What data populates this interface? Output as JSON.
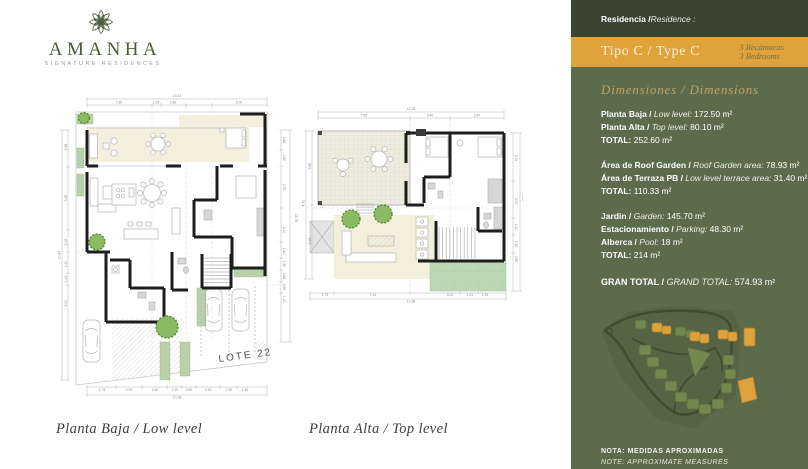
{
  "brand": {
    "name": "AMANHA",
    "tagline": "SIGNATURE RESIDENCES",
    "rosette_icon": "mandala-rosette"
  },
  "captions": {
    "planta_baja": "Planta Baja / Low level",
    "planta_alta": "Planta Alta / Top level"
  },
  "lot_label": "LOTE 22",
  "sidebar": {
    "residence_label_es": "Residencia / ",
    "residence_label_en": "Residence :",
    "type": {
      "title": "Tipo C / Type C",
      "bedrooms_es": "3 Recámaras",
      "bedrooms_en": "3 Bedrooms"
    },
    "dimensions_heading": "Dimensiones / Dimensions",
    "groups": [
      {
        "rows": [
          {
            "es": "Planta Baja / ",
            "en": "Low level:",
            "value": "172.50 m²"
          },
          {
            "es": "Planta Alta / ",
            "en": "Top level:",
            "value": "80.10 m²"
          }
        ],
        "total_label": "TOTAL:",
        "total_value": "252.60 m²"
      },
      {
        "rows": [
          {
            "es": "Área de Roof Garden / ",
            "en": "Roof Garden area:",
            "value": "78.93 m²"
          },
          {
            "es": "Área de Terraza PB / ",
            "en": "Low level terrace area:",
            "value": "31.40 m²"
          }
        ],
        "total_label": "TOTAL:",
        "total_value": "110.33 m²"
      },
      {
        "rows": [
          {
            "es": "Jardin / ",
            "en": "Garden:",
            "value": "145.70 m²"
          },
          {
            "es": "Estacionamiento / ",
            "en": "Parking:",
            "value": "48.30 m²"
          },
          {
            "es": "Alberca / ",
            "en": "Pool:",
            "value": "18 m²"
          }
        ],
        "total_label": "TOTAL:",
        "total_value": "214 m²"
      }
    ],
    "grand_total": {
      "es": "GRAN TOTAL / ",
      "en": "GRAND TOTAL:",
      "value": "574.93 m²"
    },
    "notes": {
      "es": "NOTA: MEDIDAS APROXIMADAS",
      "en": "NOTE: APPROXIMATE MEASURES"
    }
  },
  "colors": {
    "sidebar_green": "#5d6b4d",
    "header_green": "#39452f",
    "accent_orange": "#e0a33c",
    "gold_heading": "#bfa262",
    "logo_green": "#4c5c3c",
    "terrace_cream": "#f3efdd",
    "terrace_sage": "#bdd6b5"
  },
  "floorplans": {
    "pb": {
      "dims": {
        "top": [
          {
            "x": 123,
            "y": 7,
            "t": "13.32"
          },
          {
            "x": 65,
            "y": 13.5,
            "t": "7.30"
          },
          {
            "x": 102,
            "y": 13.5,
            "t": "1.00"
          },
          {
            "x": 119,
            "y": 13.5,
            "t": "2.80"
          },
          {
            "x": 185,
            "y": 13.5,
            "t": "6.00"
          }
        ],
        "left": [
          {
            "x": 6.5,
            "y": 165,
            "t": "10.87",
            "r": -90
          },
          {
            "x": 13,
            "y": 57,
            "t": "2.98",
            "r": -90
          },
          {
            "x": 13,
            "y": 108,
            "t": "5.95",
            "r": -90
          },
          {
            "x": 13,
            "y": 152,
            "t": "2.19",
            "r": -90
          },
          {
            "x": 13,
            "y": 174,
            "t": "1.20",
            "r": -90
          },
          {
            "x": 13,
            "y": 189,
            "t": "1.14",
            "r": -90
          },
          {
            "x": 13,
            "y": 213,
            "t": "2.51",
            "r": -90
          }
        ],
        "right": [
          {
            "x": 241,
            "y": 128,
            "t": "13.78",
            "r": 90
          },
          {
            "x": 229,
            "y": 50,
            "t": "2.86",
            "r": 90
          },
          {
            "x": 229,
            "y": 68,
            "t": "0.80",
            "r": 90
          },
          {
            "x": 229,
            "y": 97,
            "t": "3.75",
            "r": 90
          },
          {
            "x": 229,
            "y": 140,
            "t": "3.10",
            "r": 90
          },
          {
            "x": 229,
            "y": 161,
            "t": "1.40",
            "r": 90
          },
          {
            "x": 229,
            "y": 174,
            "t": "1.50",
            "r": 90
          },
          {
            "x": 229,
            "y": 186,
            "t": "0.85",
            "r": 90
          },
          {
            "x": 229,
            "y": 197,
            "t": "0.85",
            "r": 90
          },
          {
            "x": 229,
            "y": 209,
            "t": "1.15",
            "r": 90
          }
        ],
        "bottom": [
          {
            "x": 48,
            "y": 301,
            "t": "1.75"
          },
          {
            "x": 75,
            "y": 301,
            "t": "2.20"
          },
          {
            "x": 101,
            "y": 301,
            "t": "1.80"
          },
          {
            "x": 121,
            "y": 301,
            "t": "1.20"
          },
          {
            "x": 135,
            "y": 301,
            "t": "0.80"
          },
          {
            "x": 154,
            "y": 301,
            "t": "2.15"
          },
          {
            "x": 175,
            "y": 301,
            "t": "1.00"
          },
          {
            "x": 191,
            "y": 301,
            "t": "1.40"
          },
          {
            "x": 123,
            "y": 308.5,
            "t": "10.78"
          }
        ]
      }
    },
    "pa": {
      "dims": {
        "top": [
          {
            "x": 113,
            "y": 7,
            "t": "12.38"
          },
          {
            "x": 66,
            "y": 13.5,
            "t": "7.50"
          },
          {
            "x": 132,
            "y": 13.5,
            "t": "3.40"
          },
          {
            "x": 179,
            "y": 13.5,
            "t": "3.40"
          }
        ],
        "left": [
          {
            "x": 6.5,
            "y": 100,
            "t": "4.70",
            "r": -90
          },
          {
            "x": 13,
            "y": 63,
            "t": "5.85",
            "r": -90
          },
          {
            "x": 13,
            "y": 138,
            "t": "5.15",
            "r": -90
          }
        ],
        "right": [
          {
            "x": 224,
            "y": 95,
            "t": "8.40",
            "r": 90
          },
          {
            "x": 217,
            "y": 55,
            "t": "4.15",
            "r": 90
          },
          {
            "x": 217,
            "y": 98,
            "t": "3.00",
            "r": 90
          },
          {
            "x": 217,
            "y": 124,
            "t": "1.20",
            "r": 90
          },
          {
            "x": 217,
            "y": 141,
            "t": "1.30",
            "r": 90
          },
          {
            "x": 217,
            "y": 156,
            "t": "0.85",
            "r": 90
          }
        ],
        "bottom": [
          {
            "x": 27,
            "y": 193,
            "t": "1.75"
          },
          {
            "x": 75,
            "y": 193,
            "t": "7.44"
          },
          {
            "x": 152,
            "y": 193,
            "t": "3.20"
          },
          {
            "x": 172,
            "y": 193,
            "t": "1.24"
          },
          {
            "x": 187,
            "y": 193,
            "t": "1.39"
          },
          {
            "x": 113,
            "y": 199.5,
            "t": "12.38"
          }
        ]
      }
    }
  }
}
